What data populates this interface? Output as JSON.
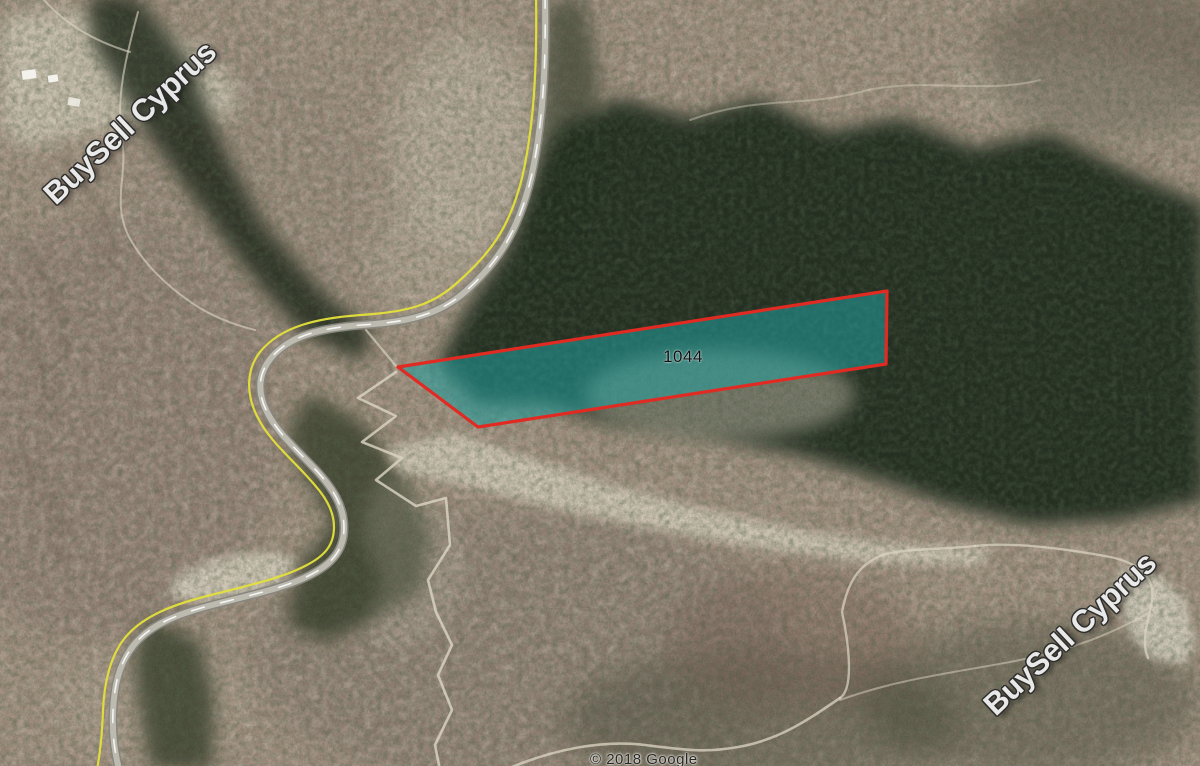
{
  "map": {
    "plot": {
      "label": "1044",
      "points": "398,367 887,291 886,364 478,427",
      "border_color": "#e12a22",
      "fill_color": "rgba(32,160,160,0.55)"
    },
    "watermark": {
      "text": "BuySell Cyprus"
    },
    "attribution": {
      "text": "© 2018 Google"
    },
    "road": {
      "boundary_line_color": "#e4e03a"
    }
  }
}
